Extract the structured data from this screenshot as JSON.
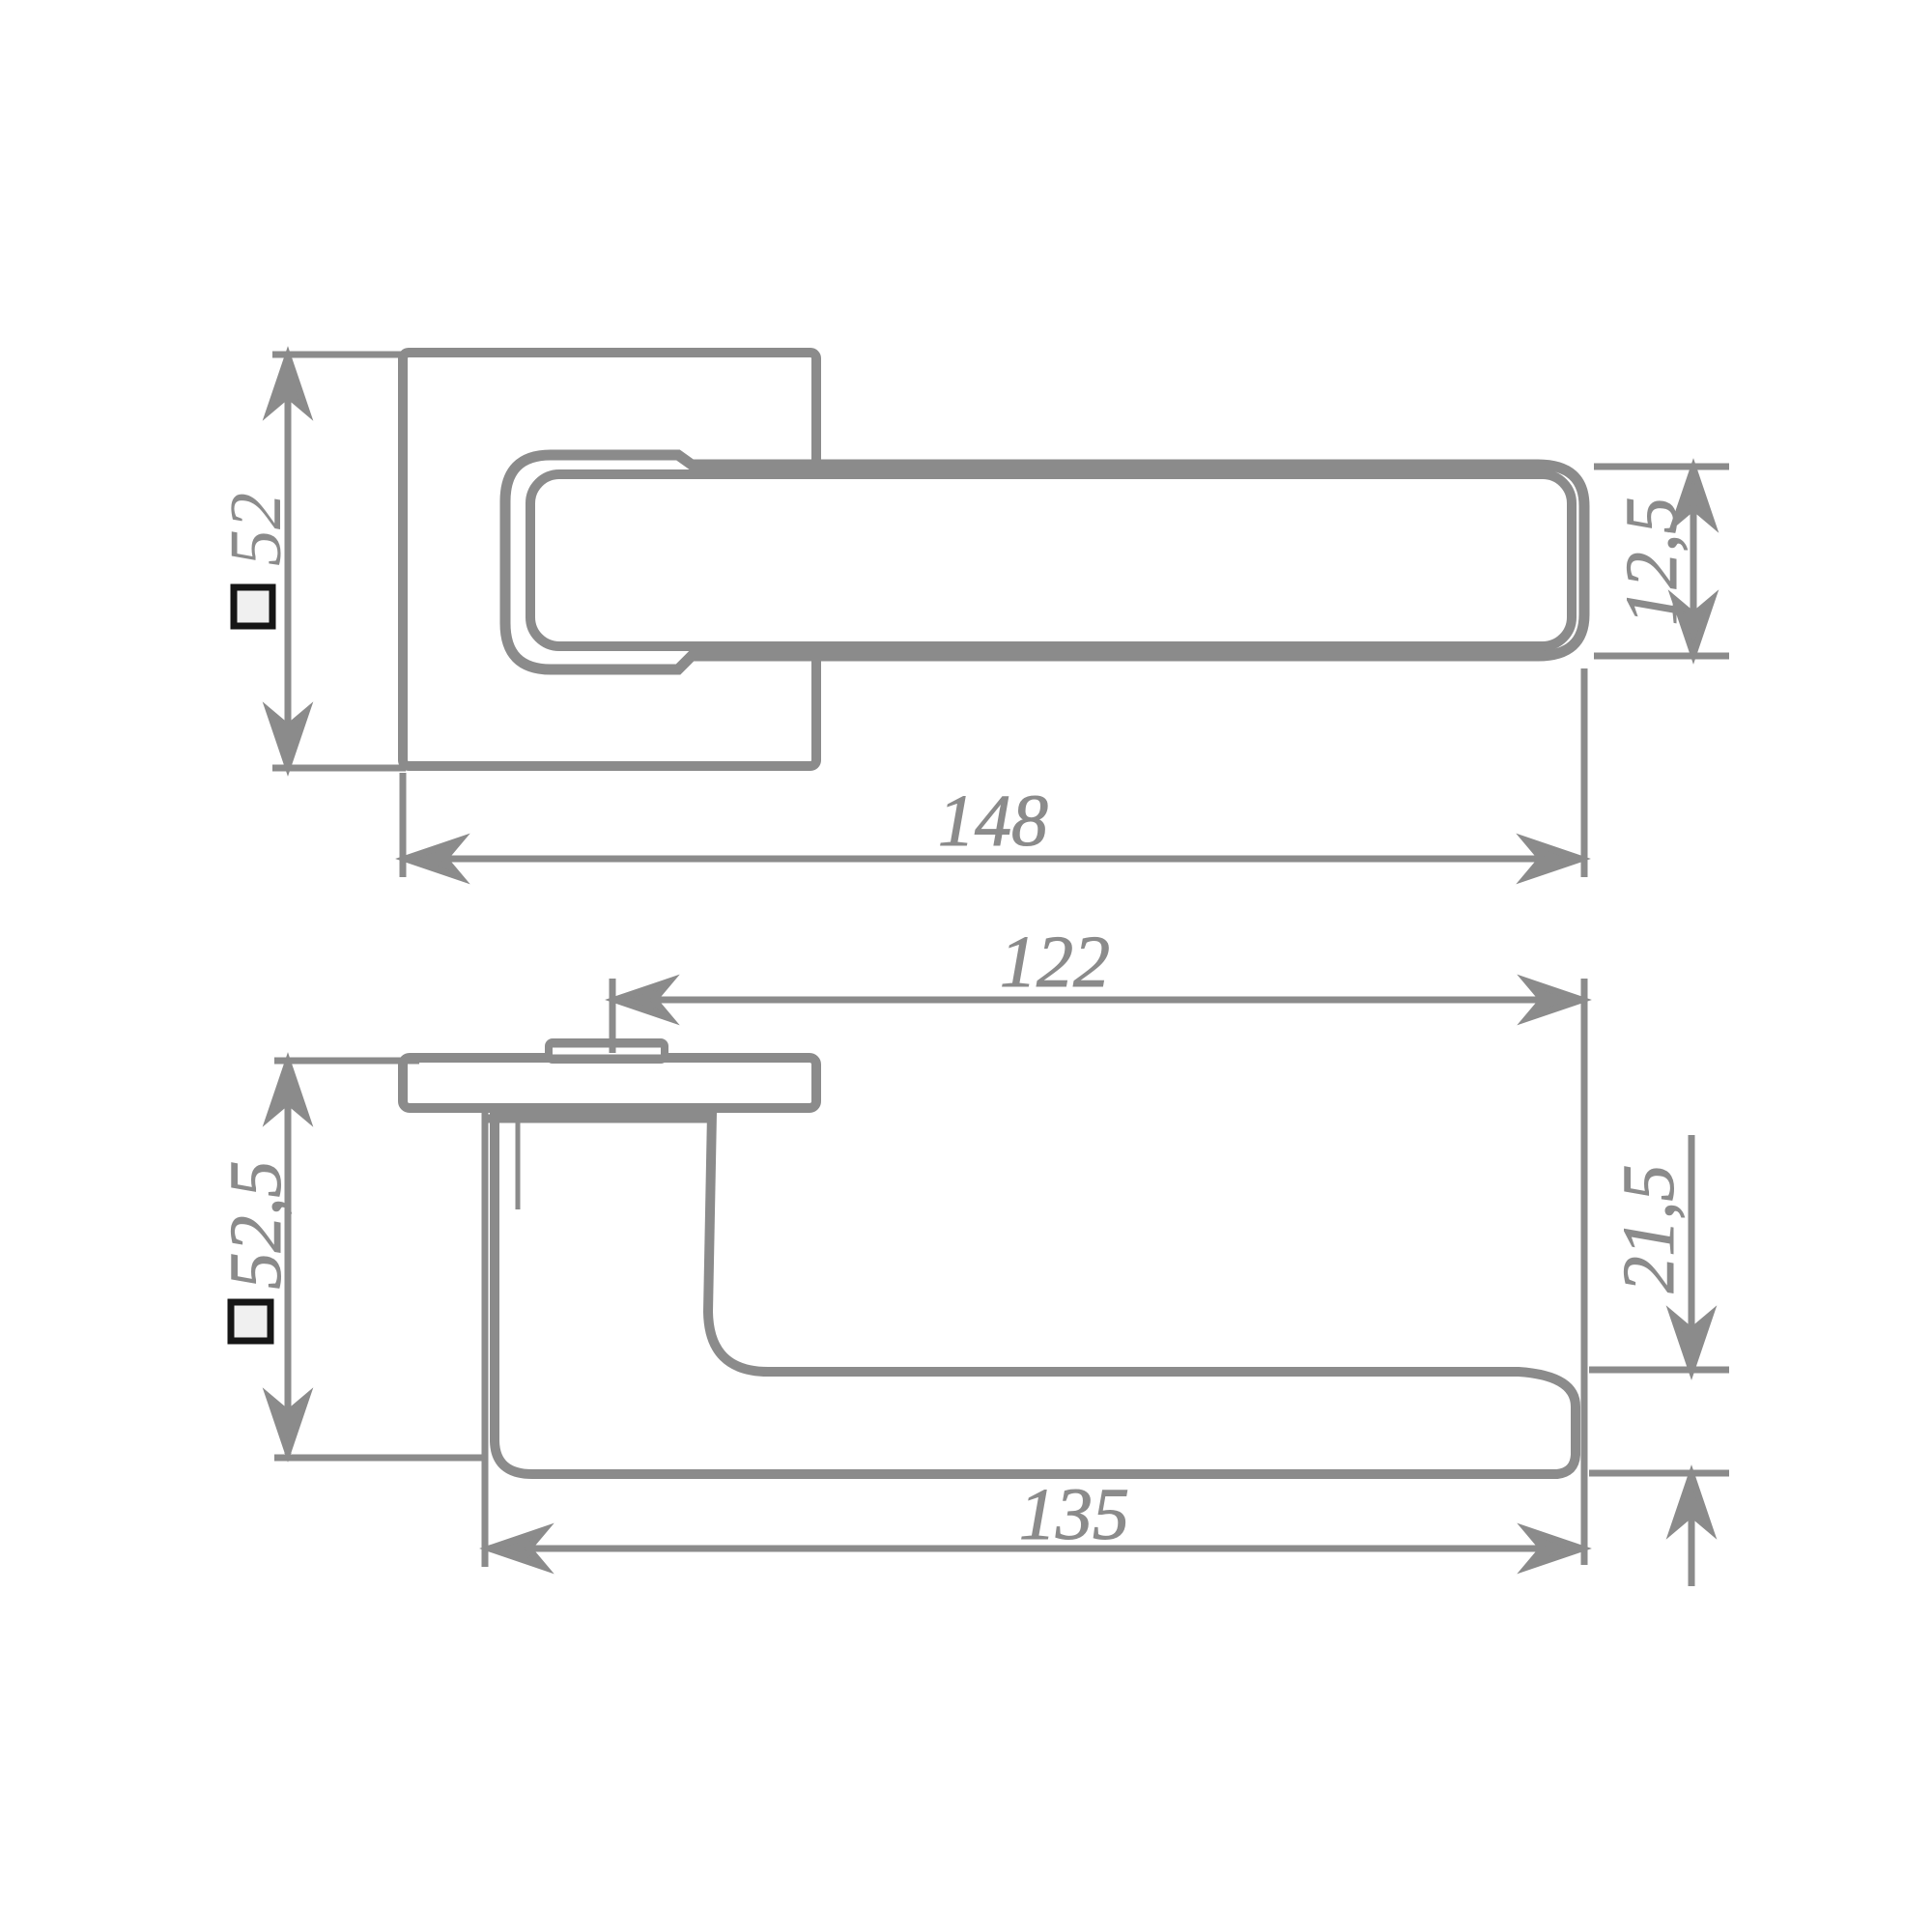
{
  "drawing": {
    "type": "door-handle-technical-drawing",
    "colors": {
      "line": "#8b8b8b",
      "text": "#8b8b8b",
      "square_symbol_border": "#161616",
      "square_symbol_fill": "#f0f0f0",
      "background": "#ffffff"
    },
    "front_view": {
      "rosette_size": "52",
      "overall_length": "148",
      "lever_thickness": "12,5"
    },
    "side_view": {
      "lever_projection": "122",
      "overall_height": "52,5",
      "lever_end_height": "21,5",
      "lever_reach": "135"
    }
  }
}
